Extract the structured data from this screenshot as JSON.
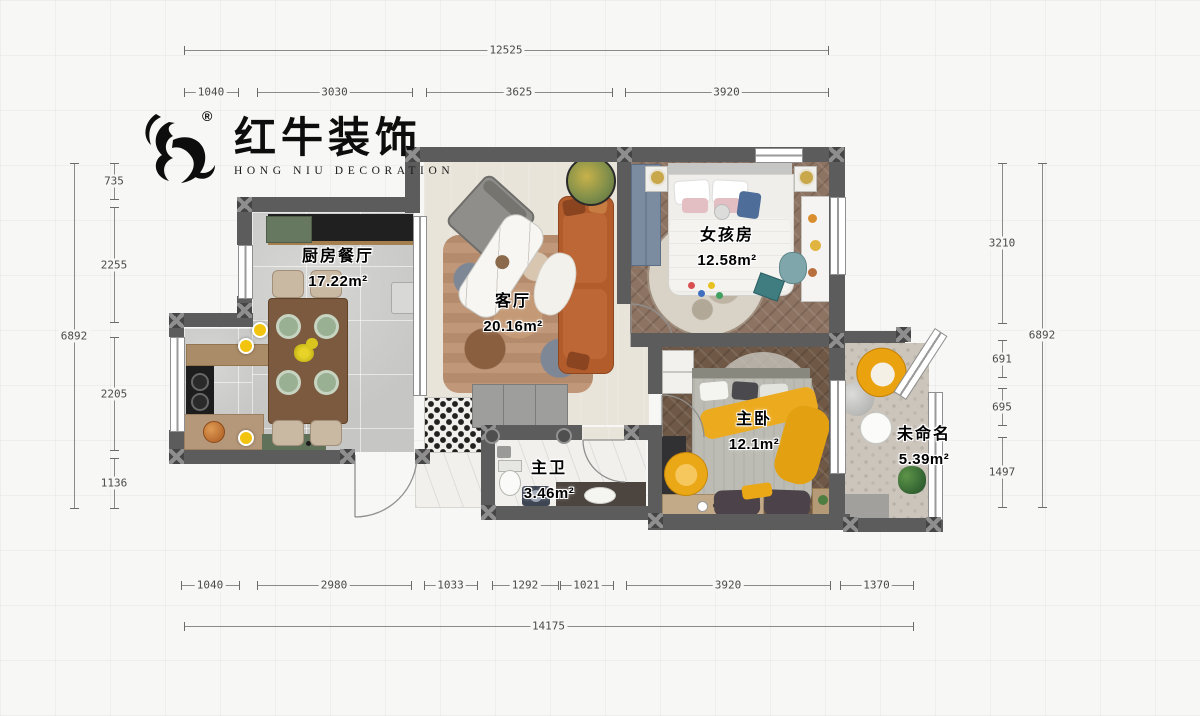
{
  "logo": {
    "brand": "红牛装饰",
    "sub": "HONG NIU DECORATION",
    "reg": "®"
  },
  "rooms": {
    "kitchen": {
      "name": "厨房餐厅",
      "area": "17.22m²"
    },
    "living": {
      "name": "客厅",
      "area": "20.16m²"
    },
    "girl": {
      "name": "女孩房",
      "area": "12.58m²"
    },
    "master": {
      "name": "主卧",
      "area": "12.1m²"
    },
    "bath": {
      "name": "主卫",
      "area": "3.46m²"
    },
    "balcony": {
      "name": "未命名",
      "area": "5.39m²"
    }
  },
  "dimensions": {
    "top_total": {
      "orientation": "h",
      "y": 50,
      "segments": [
        {
          "from": 184,
          "to": 828,
          "label": "12525"
        }
      ]
    },
    "top": {
      "orientation": "h",
      "y": 92,
      "segments": [
        {
          "from": 184,
          "to": 238,
          "label": "1040"
        },
        {
          "from": 257,
          "to": 412,
          "label": "3030"
        },
        {
          "from": 426,
          "to": 612,
          "label": "3625"
        },
        {
          "from": 625,
          "to": 828,
          "label": "3920"
        }
      ]
    },
    "bottom": {
      "orientation": "h",
      "y": 585,
      "segments": [
        {
          "from": 181,
          "to": 239,
          "label": "1040"
        },
        {
          "from": 257,
          "to": 411,
          "label": "2980"
        },
        {
          "from": 424,
          "to": 477,
          "label": "1033"
        },
        {
          "from": 492,
          "to": 558,
          "label": "1292"
        },
        {
          "from": 560,
          "to": 613,
          "label": "1021"
        },
        {
          "from": 626,
          "to": 830,
          "label": "3920"
        },
        {
          "from": 840,
          "to": 913,
          "label": "1370"
        }
      ]
    },
    "bottom_total": {
      "orientation": "h",
      "y": 626,
      "segments": [
        {
          "from": 184,
          "to": 913,
          "label": "14175"
        }
      ]
    },
    "left_inner": {
      "orientation": "v",
      "x": 114,
      "segments": [
        {
          "from": 163,
          "to": 199,
          "label": "735"
        },
        {
          "from": 207,
          "to": 322,
          "label": "2255"
        },
        {
          "from": 337,
          "to": 450,
          "label": "2205"
        },
        {
          "from": 458,
          "to": 508,
          "label": "1136"
        }
      ]
    },
    "left_outer": {
      "orientation": "v",
      "x": 74,
      "segments": [
        {
          "from": 163,
          "to": 508,
          "label": "6892"
        }
      ]
    },
    "right_inner": {
      "orientation": "v",
      "x": 1002,
      "segments": [
        {
          "from": 163,
          "to": 323,
          "label": "3210"
        },
        {
          "from": 340,
          "to": 377,
          "label": "691"
        },
        {
          "from": 388,
          "to": 425,
          "label": "695"
        },
        {
          "from": 437,
          "to": 507,
          "label": "1497"
        }
      ]
    },
    "right_outer": {
      "orientation": "v",
      "x": 1042,
      "segments": [
        {
          "from": 163,
          "to": 507,
          "label": "6892"
        }
      ]
    }
  },
  "icons": {
    "logo_mark": "bull-icon"
  },
  "colors": {
    "wall": "#5c5c5c",
    "sofa_rust": "#b25c2c",
    "accent_yellow": "#eaa816",
    "cabinet_green": "#66785f",
    "wardrobe_blue": "#7b8ba0",
    "floor_tile": "#c6c6c4",
    "floor_cream": "#e9e4da",
    "floor_wood_girl": "#8d7362",
    "floor_wood_master": "#6f5846",
    "dim_text": "#4a4a4a"
  }
}
